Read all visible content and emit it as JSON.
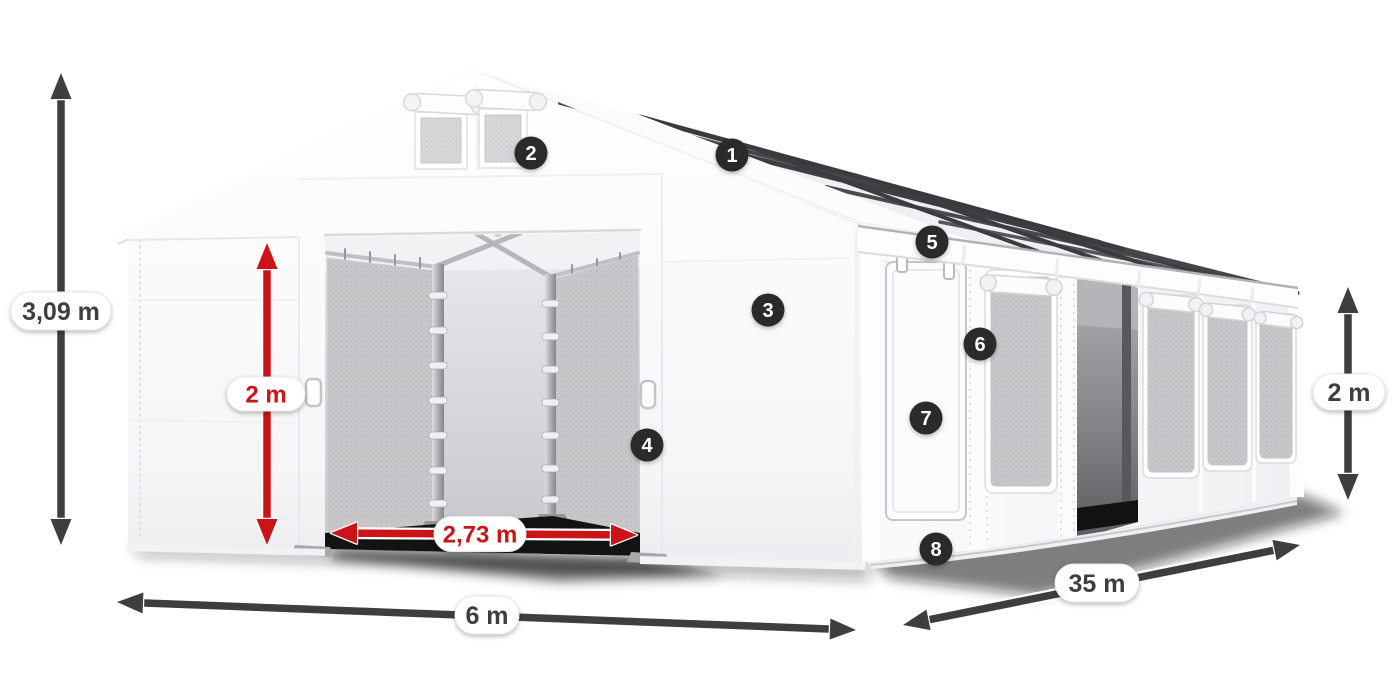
{
  "diagram": {
    "background": "#ffffff",
    "colors": {
      "dimension_dark": "#3e3e3e",
      "dimension_red": "#cc1318",
      "pill_background": "#ffffff",
      "marker_background": "#2a2a2a",
      "marker_text": "#ffffff",
      "tent_white": "#fcfcfd"
    },
    "dimensions": [
      {
        "id": "total-height",
        "label": "3,09 m",
        "style": "dark"
      },
      {
        "id": "door-height",
        "label": "2 m",
        "style": "red"
      },
      {
        "id": "door-width",
        "label": "2,73 m",
        "style": "red"
      },
      {
        "id": "front-width",
        "label": "6 m",
        "style": "dark"
      },
      {
        "id": "length",
        "label": "35 m",
        "style": "dark"
      },
      {
        "id": "side-height",
        "label": "2 m",
        "style": "dark"
      }
    ],
    "markers": [
      {
        "number": "1"
      },
      {
        "number": "2"
      },
      {
        "number": "3"
      },
      {
        "number": "4"
      },
      {
        "number": "5"
      },
      {
        "number": "6"
      },
      {
        "number": "7"
      },
      {
        "number": "8"
      }
    ]
  }
}
